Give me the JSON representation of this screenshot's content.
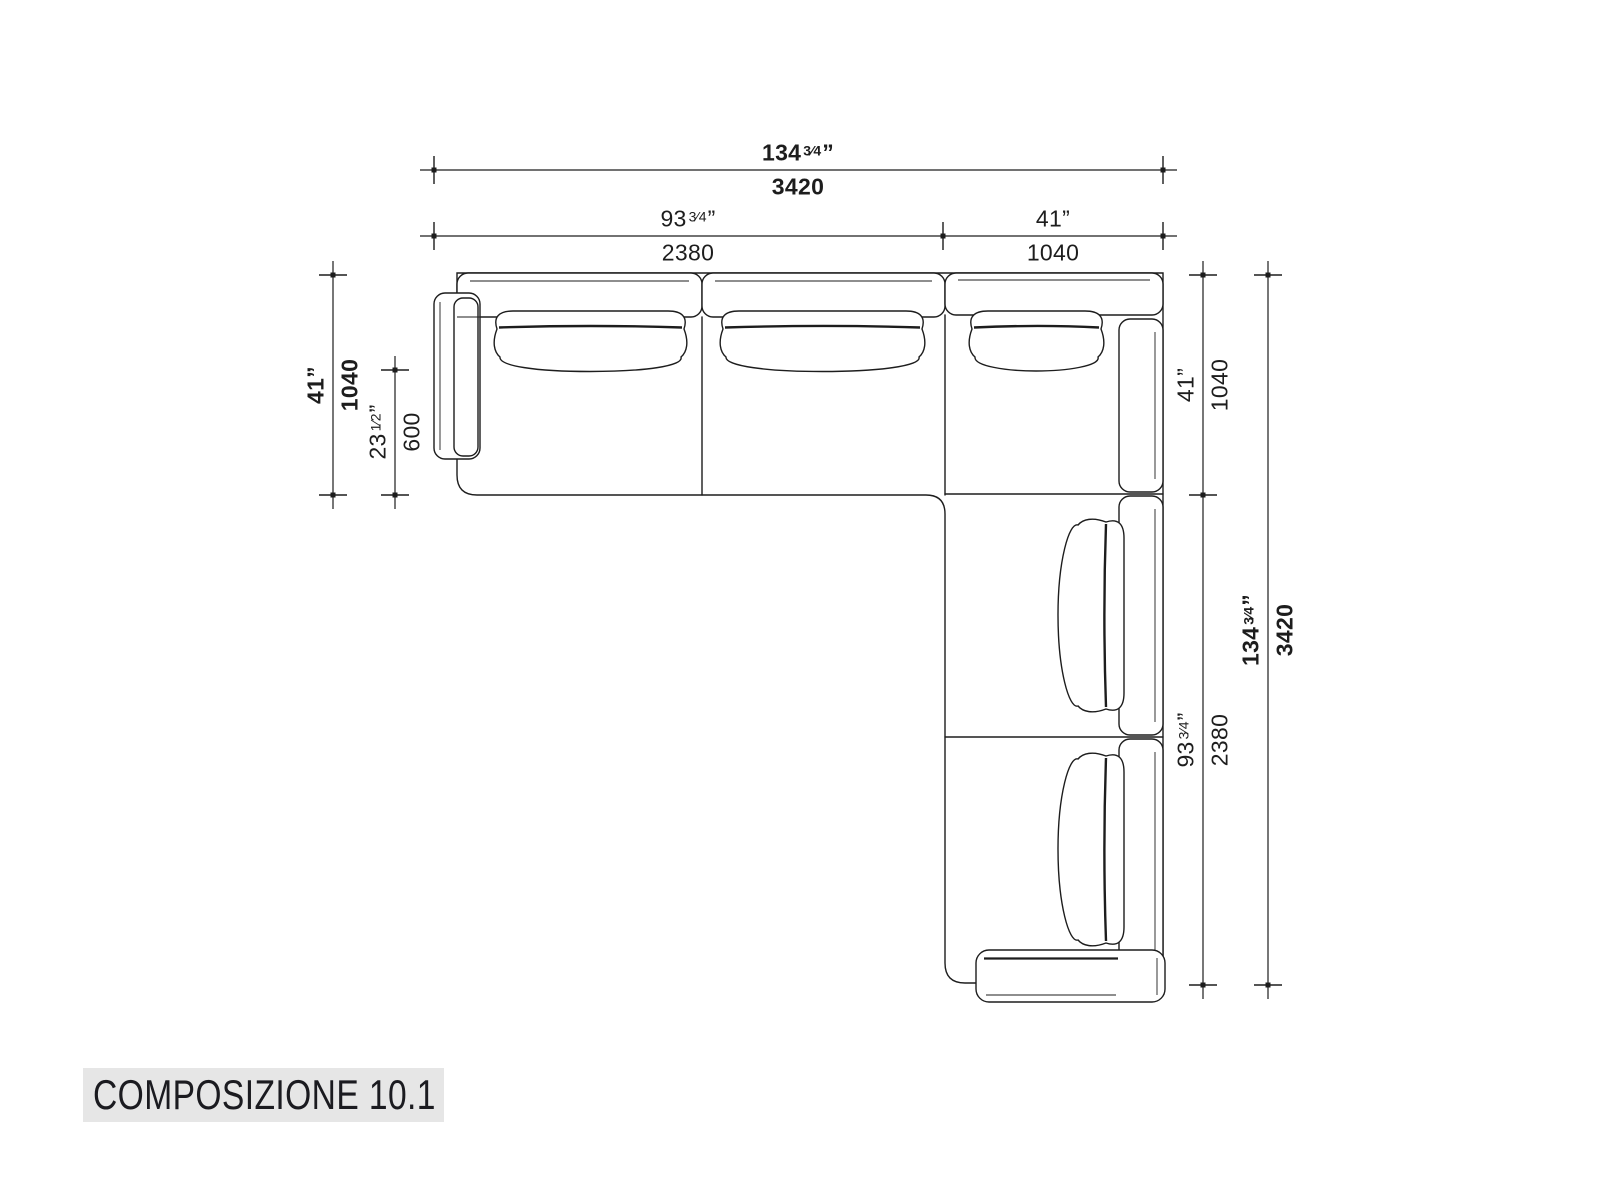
{
  "meta": {
    "ink_color": "#1d1d1d",
    "title_bg": "#e6e6e6"
  },
  "title": {
    "label": "COMPOSIZIONE 10.1"
  },
  "dims": {
    "top_total": {
      "in_whole": "134",
      "frac": "3⁄4",
      "unit": "”",
      "mm": "3420"
    },
    "top_seats": {
      "in_whole": "93",
      "frac": "3⁄4",
      "unit": "”",
      "mm": "2380"
    },
    "top_corner": {
      "in_whole": "41",
      "frac": "",
      "unit": "”",
      "mm": "1040"
    },
    "left_depth": {
      "in_whole": "41",
      "frac": "",
      "unit": "”",
      "mm": "1040"
    },
    "left_seat_depth": {
      "in_whole": "23",
      "frac": "1⁄2",
      "unit": "”",
      "mm": "600"
    },
    "right_corner": {
      "in_whole": "41",
      "frac": "",
      "unit": "”",
      "mm": "1040"
    },
    "right_seats": {
      "in_whole": "93",
      "frac": "3⁄4",
      "unit": "”",
      "mm": "2380"
    },
    "right_total": {
      "in_whole": "134",
      "frac": "3⁄4",
      "unit": "”",
      "mm": "3420"
    }
  }
}
